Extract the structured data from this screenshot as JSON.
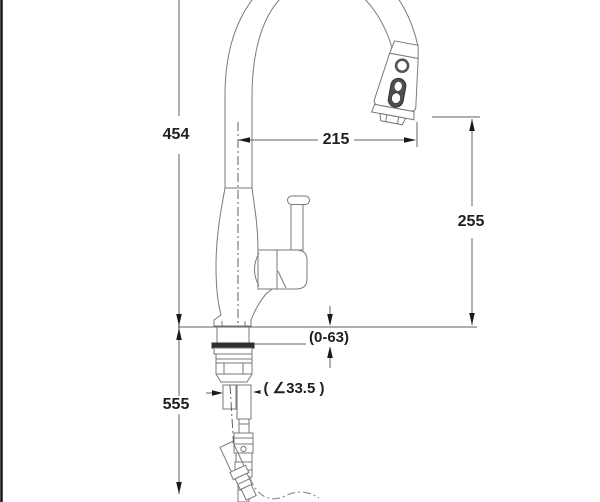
{
  "figure": {
    "type": "technical-dimension-drawing",
    "subject": "pull-down kitchen faucet, side view with installation dimensions"
  },
  "labels": {
    "overall_height": "454",
    "spout_reach": "215",
    "spout_height": "255",
    "deck_thickness_range": "(0-63)",
    "shank_diameter": "( ∠33.5 )",
    "below_deck_length": "555"
  },
  "colors": {
    "line": "#7a7a7a",
    "dim": "#616161",
    "arrow": "#1a1a1a",
    "text": "#1f1f1f",
    "washer": "#2e2e2e",
    "button": "#4f4f4f",
    "phantom": "#8f8f8f",
    "braid": "#9a9a9a",
    "border": "#161616"
  }
}
